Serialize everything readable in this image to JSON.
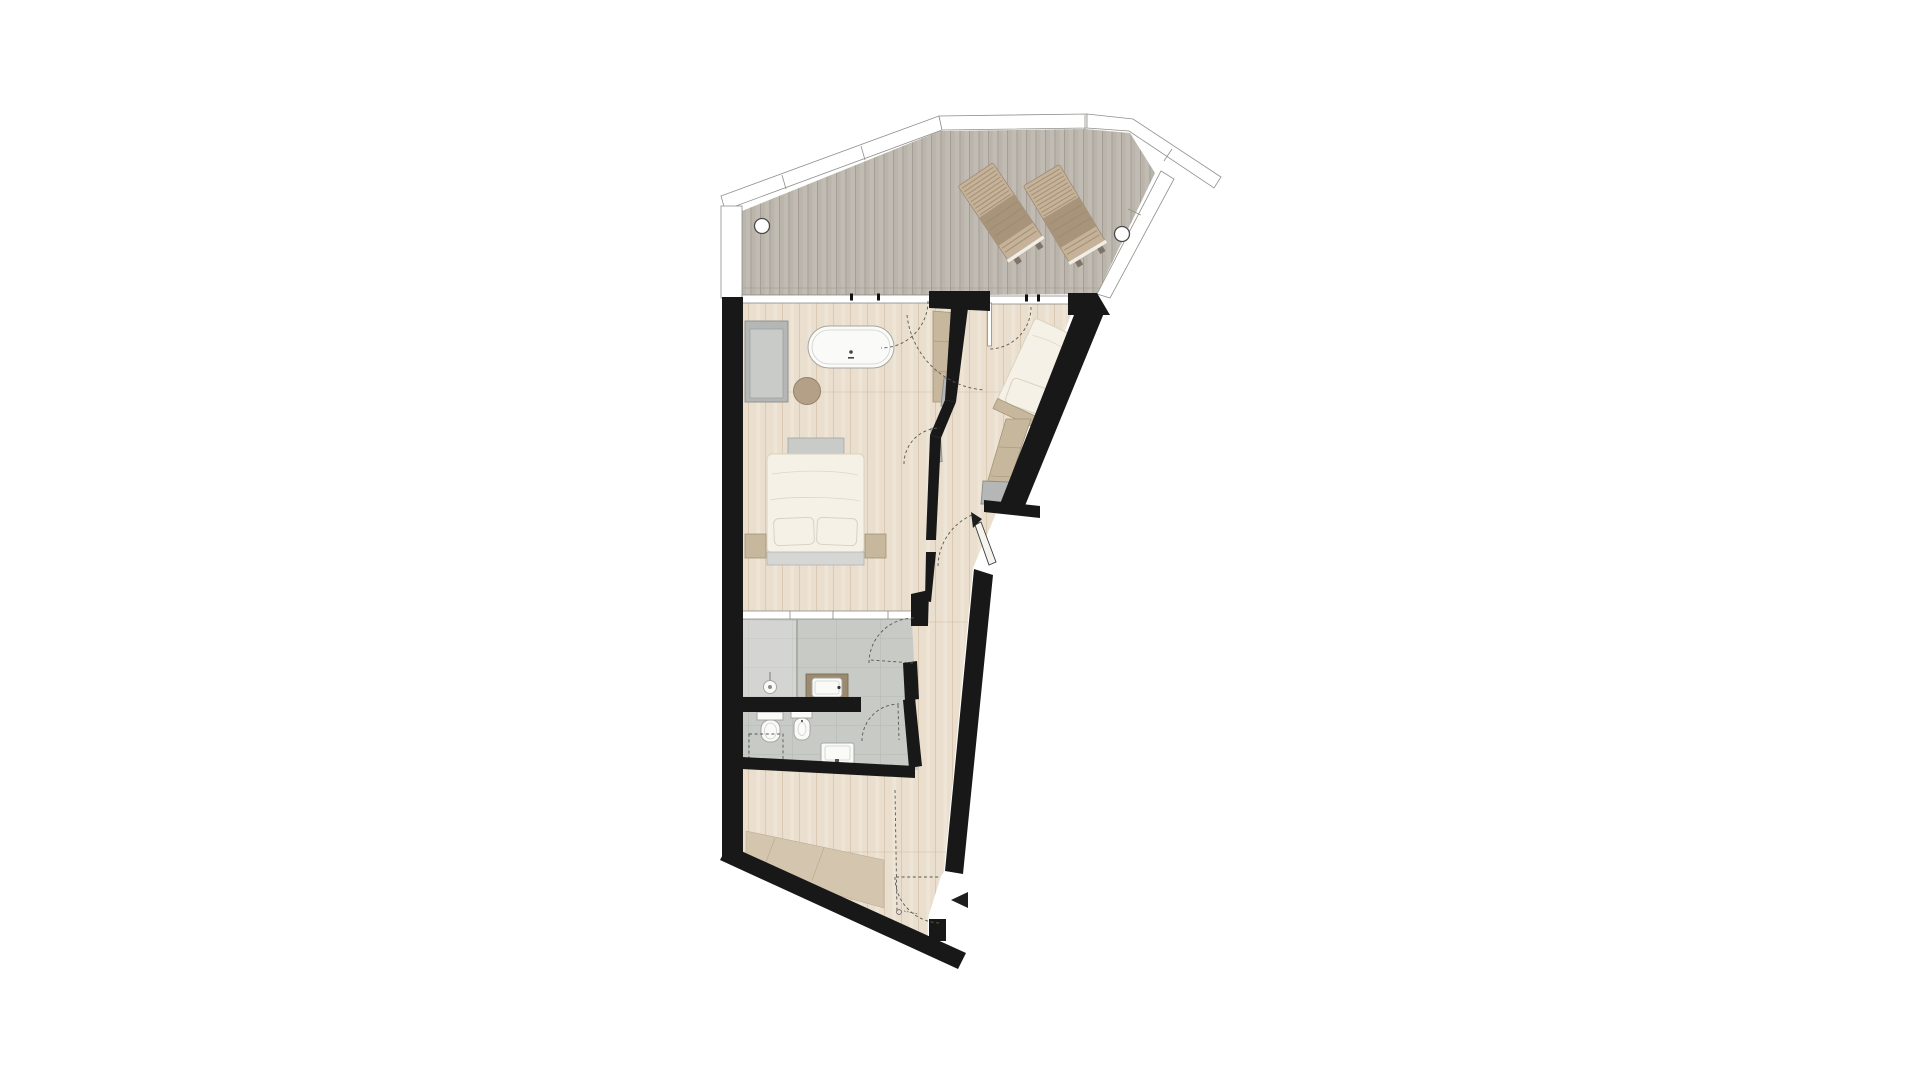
{
  "page": {
    "background": "#ffffff",
    "content": "architectural floor plan, top-down view, no text labels"
  },
  "colors": {
    "wall": "#181818",
    "deck-base": "#bab4ab",
    "deck-line": "#9d968e",
    "rail": "#ffffff",
    "rail-stroke": "#8f8f8a",
    "wood-base": "#eadfce",
    "wood-line": "#cbb394",
    "tile-base": "#c8cac6",
    "tile-line": "#9fa49d",
    "fixture": "#fafaf8",
    "fixture-stroke": "#a6a6a1",
    "gray-furniture": "#b4b7b6",
    "gray-furniture-light": "#c8cbc8",
    "tan": "#c6b79d",
    "tan-stroke": "#a4947a",
    "lounger-slat": "#c6b298",
    "lounger-seat": "#a8937b",
    "bed-white": "#f6f1e7",
    "bed-stroke": "#d9d2c2",
    "counter": "#9a8a6f",
    "stool": "#b3a086",
    "dash": "#585852",
    "arrow": "#1e1e1e",
    "dark-floor": "#d4c5ae"
  },
  "terrace": {
    "floor": "grey wood decking, vertical planks",
    "sun_loungers": 2,
    "railing_posts": 2,
    "railing": "white band with panel joints along slanted top and right edges"
  },
  "bedroom": {
    "floor": "light wood planks",
    "furniture": [
      "wardrobe",
      "freestanding bathtub",
      "round side stool",
      "double bed",
      "foot bench",
      "headboard",
      "nightstand left",
      "nightstand right"
    ],
    "glazing": "full-width window band to terrace"
  },
  "bathroom": {
    "floor": "grey stone tiles",
    "fixtures": [
      "walk-in shower with glass screen",
      "rain shower head",
      "vanity counter with basin",
      "toilet",
      "bidet",
      "second basin"
    ],
    "partition_wall": true,
    "planning_outline": "dashed reserved area below toilet"
  },
  "hallway": {
    "features": [
      "built-in cabinets",
      "sliding pocket door",
      "door swings",
      "glass partition to bathroom"
    ]
  },
  "second_bedroom": {
    "furniture": [
      "single bed (rotated)",
      "built-in cabinet run"
    ],
    "access": "door from terrace side"
  },
  "entry": {
    "features": [
      "entry door with swing",
      "black direction arrow",
      "angled open door leaf with arrow tip",
      "darker floor mat area",
      "threshold symbol"
    ]
  },
  "door_swings_total": 8
}
